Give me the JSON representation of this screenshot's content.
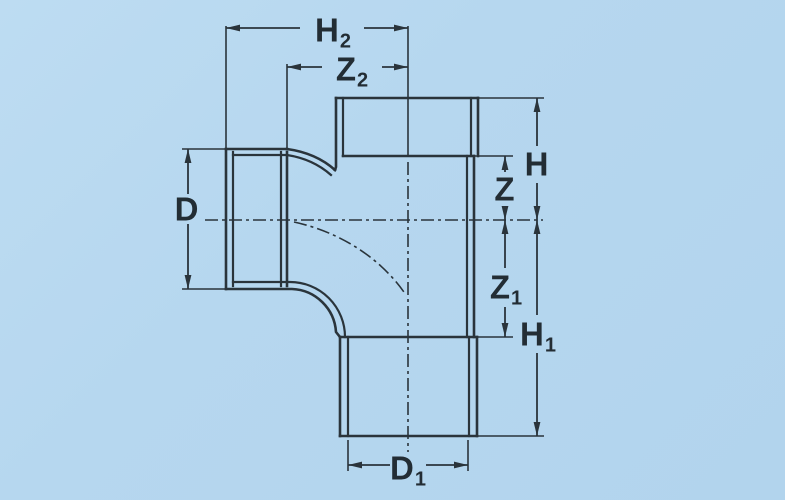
{
  "diagram": {
    "title": "Swept tee pipe fitting - dimensional drawing",
    "background_color": "#b6d7ef",
    "line_color": "#2a343b",
    "text_color": "#232d34",
    "labels": {
      "h2": {
        "main": "H",
        "sub": "2"
      },
      "z2": {
        "main": "Z",
        "sub": "2"
      },
      "d": {
        "main": "D",
        "sub": ""
      },
      "h": {
        "main": "H",
        "sub": ""
      },
      "z": {
        "main": "Z",
        "sub": ""
      },
      "z1": {
        "main": "Z",
        "sub": "1"
      },
      "h1": {
        "main": "H",
        "sub": "1"
      },
      "d1": {
        "main": "D",
        "sub": "1"
      }
    },
    "dimensions": [
      {
        "id": "H2",
        "measures": "left socket mouth to vertical axis"
      },
      {
        "id": "Z2",
        "measures": "left socket shoulder to vertical axis"
      },
      {
        "id": "D",
        "measures": "left socket outer diameter"
      },
      {
        "id": "H",
        "measures": "top socket mouth to horizontal axis"
      },
      {
        "id": "Z",
        "measures": "top socket shoulder to horizontal axis"
      },
      {
        "id": "Z1",
        "measures": "horizontal axis to bottom socket shoulder"
      },
      {
        "id": "H1",
        "measures": "horizontal axis to bottom socket mouth"
      },
      {
        "id": "D1",
        "measures": "bottom socket bore diameter"
      }
    ]
  }
}
